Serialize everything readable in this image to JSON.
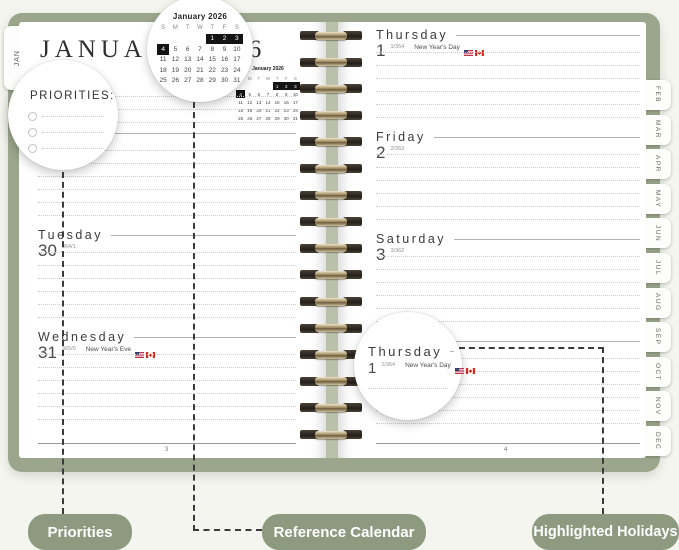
{
  "title": {
    "month": "JANUARY",
    "year": "2026"
  },
  "jan_tab": "JAN",
  "month_tabs": [
    "FEB",
    "MAR",
    "APR",
    "MAY",
    "JUN",
    "JUL",
    "AUG",
    "SEP",
    "OCT",
    "NOV",
    "DEC"
  ],
  "priorities": {
    "label": "PRIORITIES:"
  },
  "mini_calendar": {
    "title": "January 2026",
    "weekdays": [
      "S",
      "M",
      "T",
      "W",
      "T",
      "F",
      "S"
    ],
    "weeks": [
      [
        "",
        "",
        "",
        "",
        "1",
        "2",
        "3"
      ],
      [
        "4",
        "5",
        "6",
        "7",
        "8",
        "9",
        "10"
      ],
      [
        "11",
        "12",
        "13",
        "14",
        "15",
        "16",
        "17"
      ],
      [
        "18",
        "19",
        "20",
        "21",
        "22",
        "23",
        "24"
      ],
      [
        "25",
        "26",
        "27",
        "28",
        "29",
        "30",
        "31"
      ]
    ],
    "highlighted": [
      "1",
      "2",
      "3",
      "4"
    ]
  },
  "left_page": {
    "page_number": "3",
    "days": [
      {
        "name": "Monday",
        "date": "29",
        "annotation": "363/2",
        "holiday": "",
        "flags": false
      },
      {
        "name": "Tuesday",
        "date": "30",
        "annotation": "364/1",
        "holiday": "",
        "flags": false
      },
      {
        "name": "Wednesday",
        "date": "31",
        "annotation": "365/0",
        "holiday": "New Year's Eve",
        "flags": true
      }
    ]
  },
  "right_page": {
    "page_number": "4",
    "days": [
      {
        "name": "Thursday",
        "date": "1",
        "annotation": "1/364",
        "holiday": "New Year's Day",
        "flags": true
      },
      {
        "name": "Friday",
        "date": "2",
        "annotation": "2/363",
        "holiday": "",
        "flags": false
      },
      {
        "name": "Saturday",
        "date": "3",
        "annotation": "3/362",
        "holiday": "",
        "flags": false
      },
      {
        "name": "",
        "date": "",
        "annotation": "",
        "holiday": "",
        "flags": false
      }
    ]
  },
  "magnifier_day": {
    "name": "Thursday",
    "date": "1",
    "annotation": "1/364",
    "holiday": "New Year's Day",
    "flags": true
  },
  "callouts": {
    "priorities": "Priorities",
    "reference_calendar": "Reference Calendar",
    "highlighted_holidays": "Highlighted Holidays"
  },
  "colors": {
    "cover": "#9ca68c",
    "pill": "#8e9a80",
    "highlight": "#141414"
  }
}
